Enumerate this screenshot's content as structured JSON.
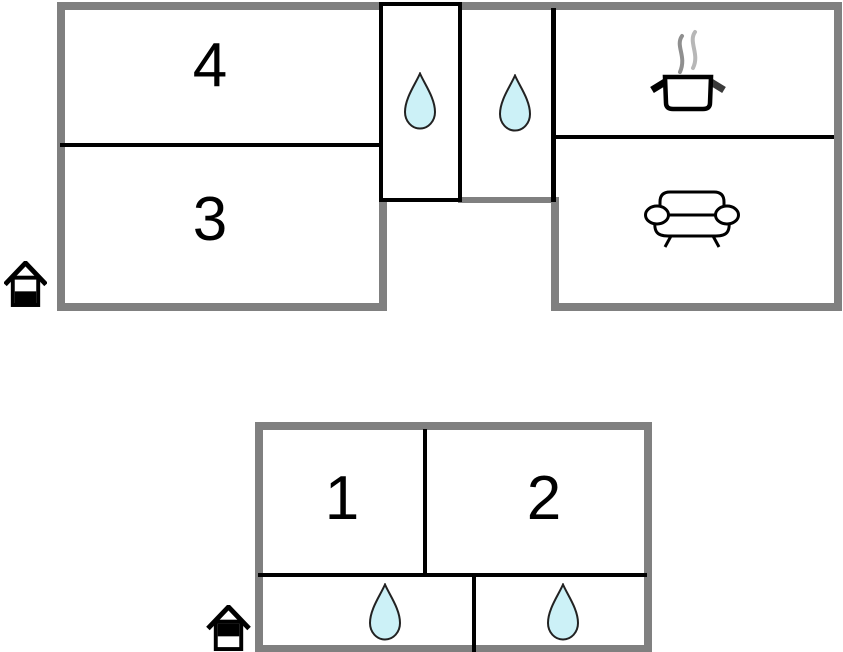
{
  "colors": {
    "wall_gray": "#808080",
    "line_black": "#000000",
    "water_fill": "#ccf1f7",
    "water_stroke": "#222222",
    "steam_dark": "#8f8f8f",
    "steam_light": "#b7b7b7"
  },
  "upper_plan": {
    "room4_label": "4",
    "room3_label": "3",
    "icons": [
      "water-drop",
      "water-drop",
      "cooking-pot",
      "sofa",
      "house-ground-floor"
    ]
  },
  "lower_plan": {
    "room1_label": "1",
    "room2_label": "2",
    "icons": [
      "water-drop",
      "water-drop",
      "house-upper-floor"
    ]
  }
}
